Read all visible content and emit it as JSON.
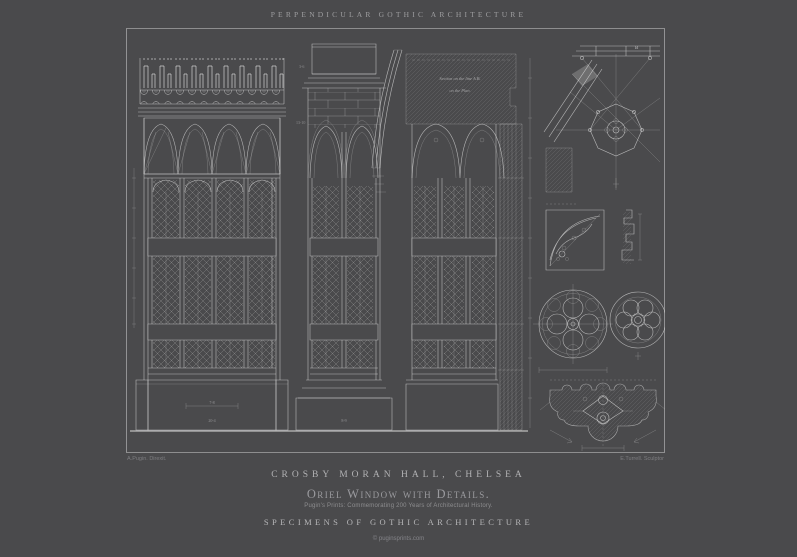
{
  "poster": {
    "header": "PERPENDICULAR GOTHIC ARCHITECTURE",
    "title": "CROSBY MORAN HALL, CHELSEA",
    "subtitle": "Oriel Window with Details.",
    "tagline": "Pugin's Prints: Commemorating 200 Years of Architectural History.",
    "series_title": "SPECIMENS OF GOTHIC ARCHITECTURE",
    "copyright": "© puginsprints.com",
    "plate": {
      "credit_left": "A.Pugin. Direxit.",
      "credit_right": "E.Turrell. Sculptor",
      "section_note_line1": "Section on the line A.B.",
      "section_note_line2": "on the Plan.",
      "ceiling_plan_label": "B",
      "dimensions": {
        "left_base_width": "7-8",
        "left_base_total": "20-4",
        "middle_parapet": "3-6",
        "middle_wall": "13-10",
        "middle_base": "8-9"
      }
    },
    "colors": {
      "background": "#4a4a4c",
      "line": "#dcdcdc",
      "text_bright": "#b6b6b8",
      "text_dim": "#8a8a8c"
    }
  }
}
